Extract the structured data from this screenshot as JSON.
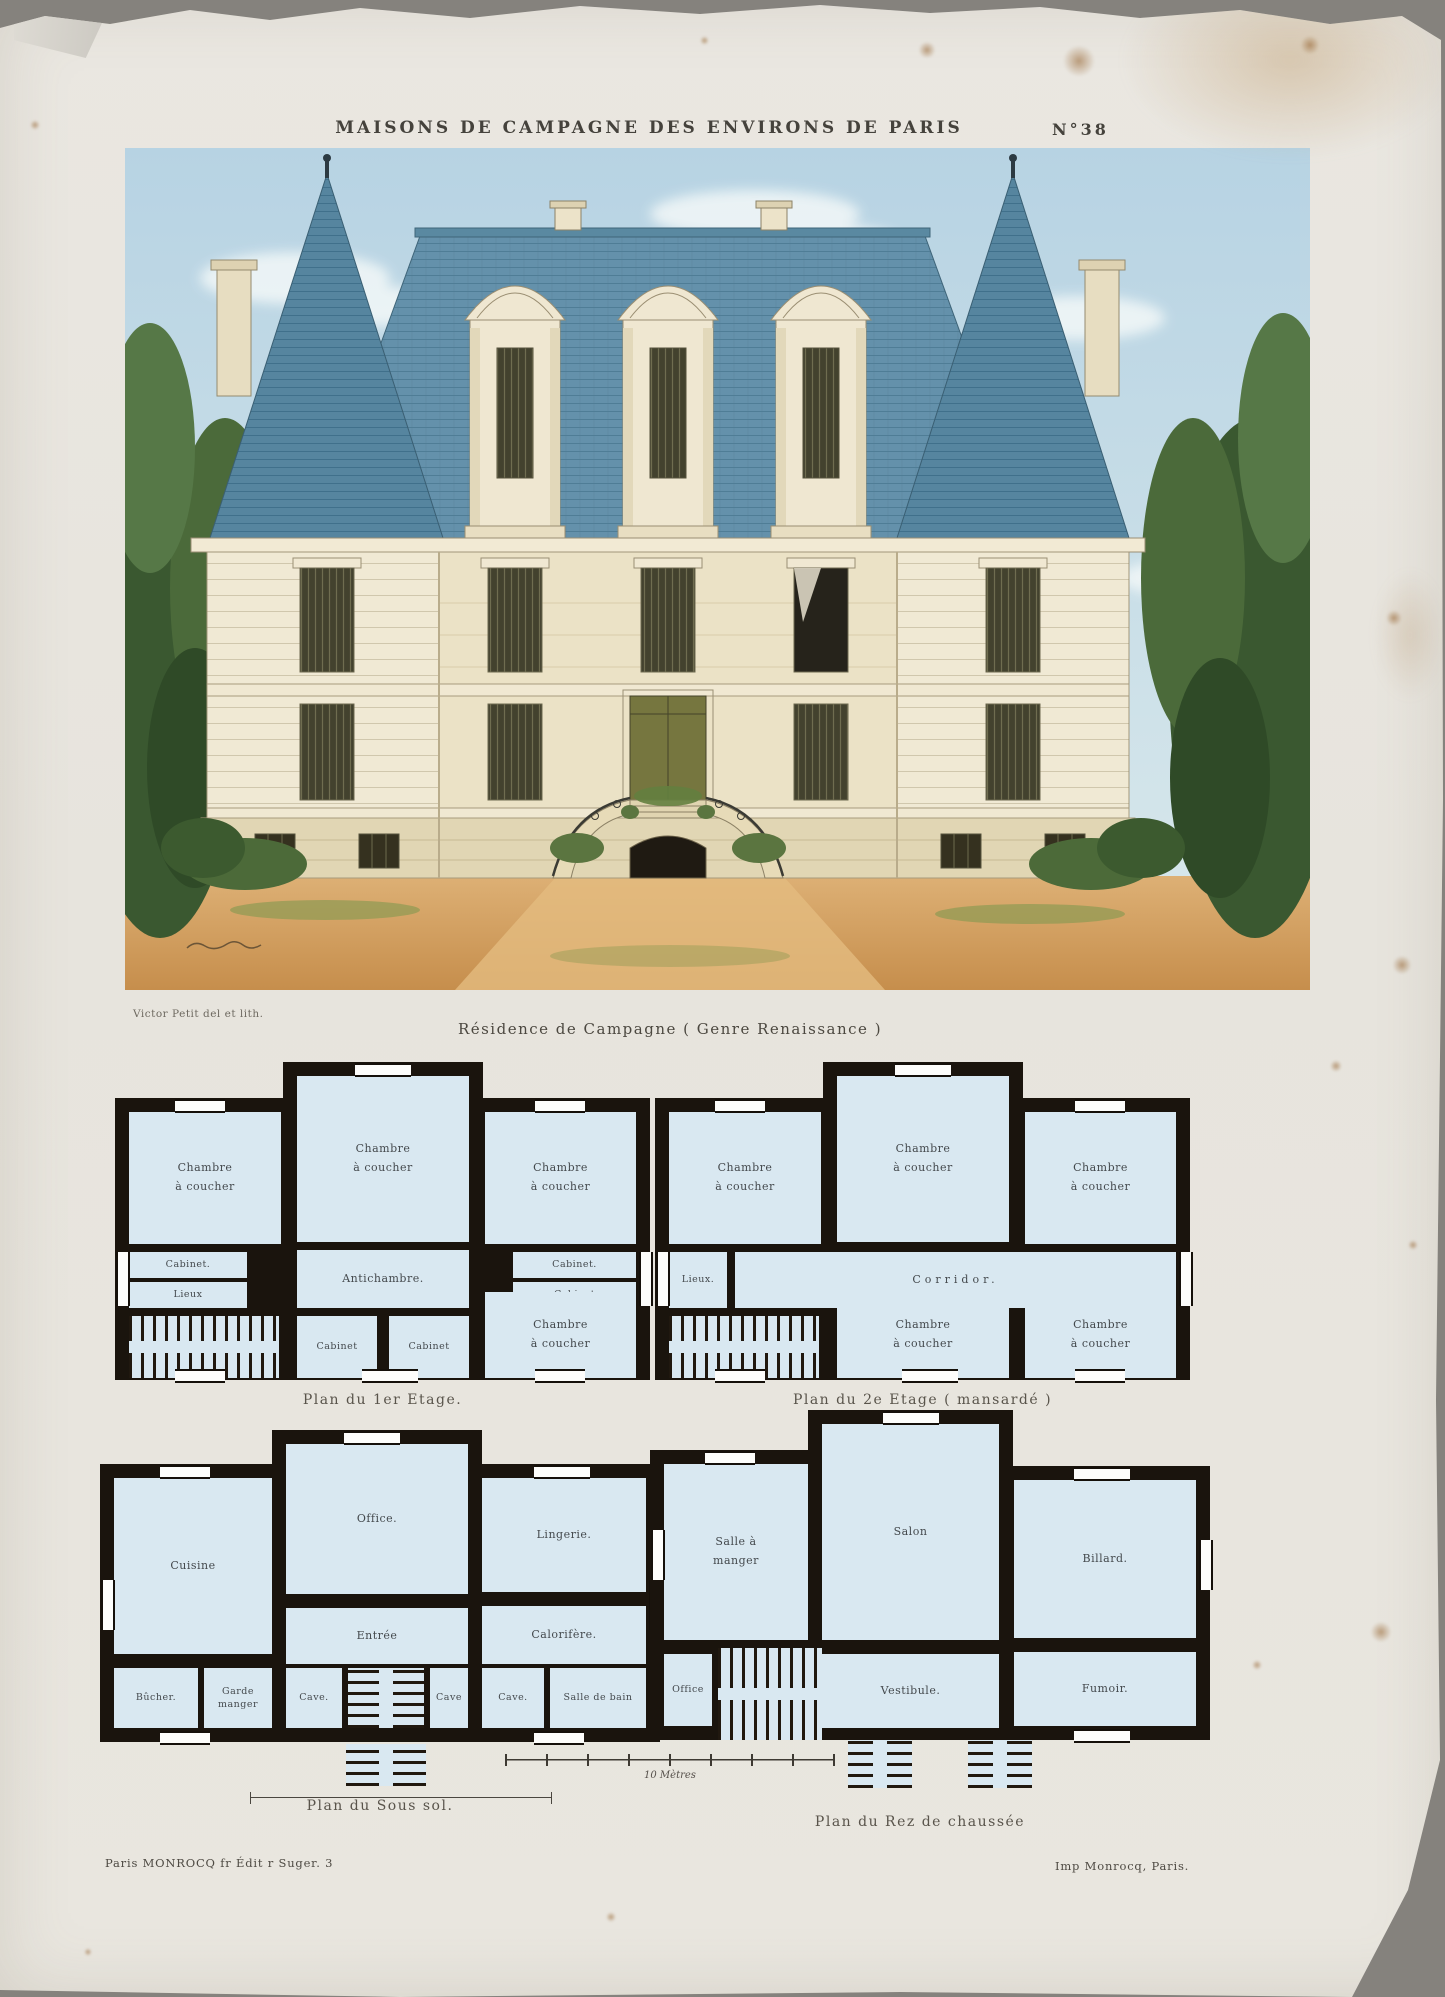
{
  "header": {
    "series_title": "MAISONS DE CAMPAGNE DES ENVIRONS DE PARIS",
    "plate_number": "N°38"
  },
  "elevation": {
    "credit": "Victor Petit del et lith.",
    "caption": "Résidence de Campagne  ( Genre Renaissance )"
  },
  "plans": {
    "premier": {
      "caption": "Plan du 1er Etage.",
      "rooms": {
        "chambre_nw": "Chambre à coucher",
        "chambre_n": "Chambre à coucher",
        "chambre_ne": "Chambre à coucher",
        "cabinet_w": "Cabinet.",
        "lieux": "Lieux",
        "antichambre": "Antichambre.",
        "cabinet_e1": "Cabinet.",
        "cabinet_e2": "Cabinet",
        "cabinet_s1": "Cabinet",
        "cabinet_s2": "Cabinet",
        "chambre_se": "Chambre à coucher"
      }
    },
    "deuxieme": {
      "caption": "Plan du 2e Etage  ( mansardé )",
      "rooms": {
        "chambre_nw": "Chambre à coucher",
        "chambre_n": "Chambre à coucher",
        "chambre_ne": "Chambre à coucher",
        "lieux": "Lieux.",
        "corridor": "Corridor.",
        "chambre_s": "Chambre à coucher",
        "chambre_se": "Chambre à coucher"
      }
    },
    "soussol": {
      "caption": "Plan du Sous sol.",
      "rooms": {
        "cuisine": "Cuisine",
        "office": "Office.",
        "lingerie": "Lingerie.",
        "entree": "Entrée",
        "calorifere": "Calorifère.",
        "bucher": "Bûcher.",
        "garde_manger": "Garde manger",
        "cave_w": "Cave.",
        "cave_c": "Cave",
        "cave_e": "Cave.",
        "salle_de_bain": "Salle de bain"
      }
    },
    "rdc": {
      "caption": "Plan du Rez de chaussée",
      "rooms": {
        "salle_a_manger": "Salle à manger",
        "salon": "Salon",
        "billard": "Billard.",
        "office": "Office",
        "vestibule": "Vestibule.",
        "fumoir": "Fumoir."
      }
    }
  },
  "scale": {
    "label": "10 Mètres"
  },
  "imprint": {
    "left": "Paris MONROCQ fr Édit r Suger. 3",
    "right": "Imp Monrocq, Paris."
  },
  "colors": {
    "paper": "#e8e5df",
    "backdrop": "#8e8b86",
    "sky": "#c0d8e6",
    "roof_slate": "#6491ab",
    "facade_cream": "#ece3c9",
    "foliage": "#44603a",
    "ground_ochre": "#d8a264",
    "plan_room_blue": "#d9e8f1",
    "plan_wall_black": "#1a140d",
    "ink": "#45423c"
  }
}
